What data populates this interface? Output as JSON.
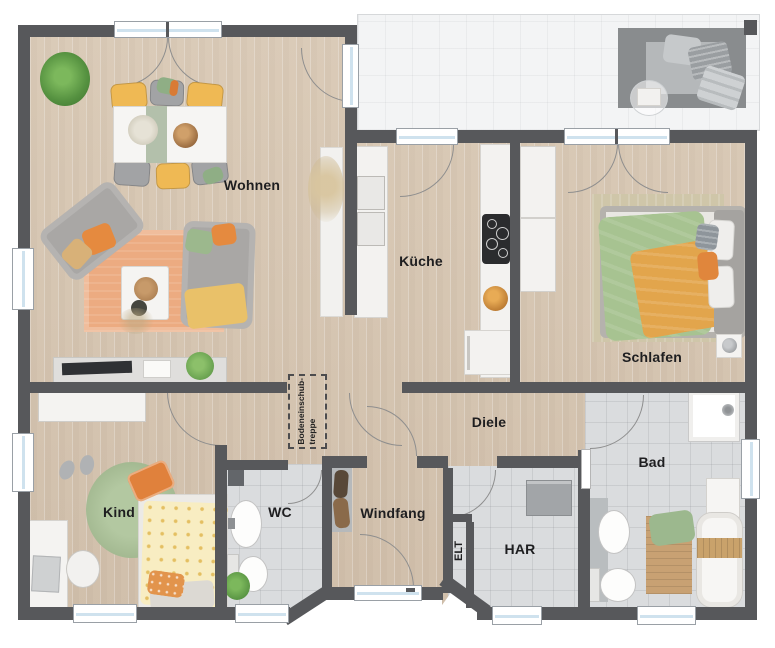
{
  "plan": {
    "title": "Erdgeschoss Grundriss (floor plan)",
    "rooms": [
      {
        "key": "wohnen",
        "label": "Wohnen"
      },
      {
        "key": "kueche",
        "label": "Küche"
      },
      {
        "key": "schlafen",
        "label": "Schlafen"
      },
      {
        "key": "diele",
        "label": "Diele"
      },
      {
        "key": "kind",
        "label": "Kind"
      },
      {
        "key": "wc",
        "label": "WC"
      },
      {
        "key": "windfang",
        "label": "Windfang"
      },
      {
        "key": "har",
        "label": "HAR"
      },
      {
        "key": "bad",
        "label": "Bad"
      },
      {
        "key": "elt",
        "label": "ELT"
      }
    ],
    "annotations": {
      "attic_ladder": "Bodeneinschub-\ntreppe"
    },
    "colors": {
      "wall": "#57585b",
      "floor_wood": "#d9cab8",
      "floor_tile": "#dadcde",
      "terrace": "#f3f4f5",
      "rug_orange": "#ecab81",
      "rug_green": "#a9bf97",
      "rug_beige": "#cfc6a9",
      "sofa_gray": "#a9a7a5",
      "chair_yellow": "#efb954",
      "pillow_orange": "#e58a3f",
      "duvet_green": "#a7c391",
      "blanket_orange": "#e2a54c",
      "kid_duvet": "#f8edc2",
      "wood_accent": "#c9a273",
      "window_glass": "#cfe2ee"
    }
  }
}
